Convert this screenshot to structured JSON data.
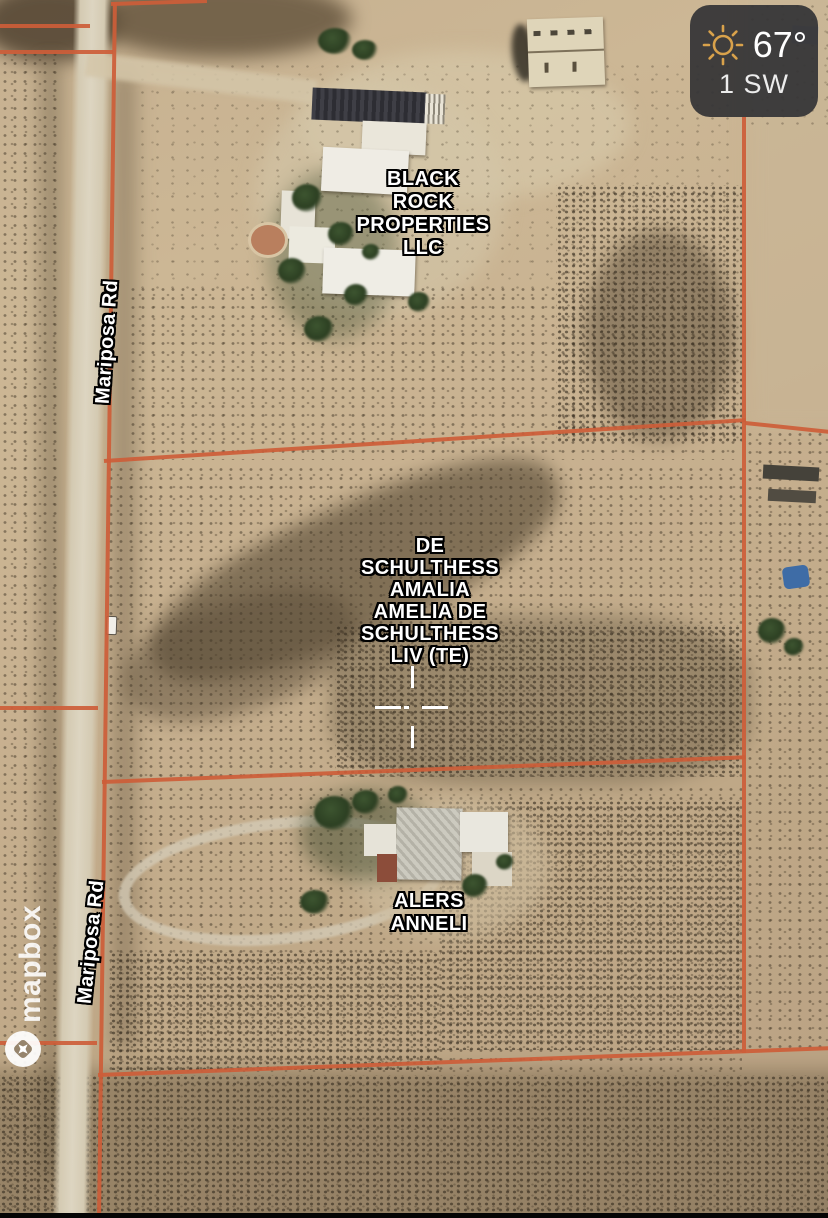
{
  "map": {
    "attribution": "mapbox",
    "road_labels": [
      "Mariposa Rd",
      "Mariposa Rd"
    ],
    "parcel_labels": [
      {
        "owner": "Black Rock Properties LLC",
        "lines": [
          "BLACK",
          "ROCK",
          "PROPERTIES",
          "LLC"
        ]
      },
      {
        "owner": "De Schulthess Amalia Amelia De Schulthess Liv (TE)",
        "lines": [
          "DE",
          "SCHULTHESS",
          "AMALIA",
          "AMELIA DE",
          "SCHULTHESS",
          "LIV (TE)"
        ]
      },
      {
        "owner": "Alers Anneli",
        "lines": [
          "ALERS",
          "ANNELI"
        ]
      }
    ],
    "colors": {
      "parcel_line": "#cd5d38",
      "label_text": "#ffffff",
      "label_outline": "#000000",
      "crosshair": "#ffffff"
    }
  },
  "weather_widget": {
    "temperature": "67°",
    "wind": "1 SW",
    "icon": "sun"
  }
}
